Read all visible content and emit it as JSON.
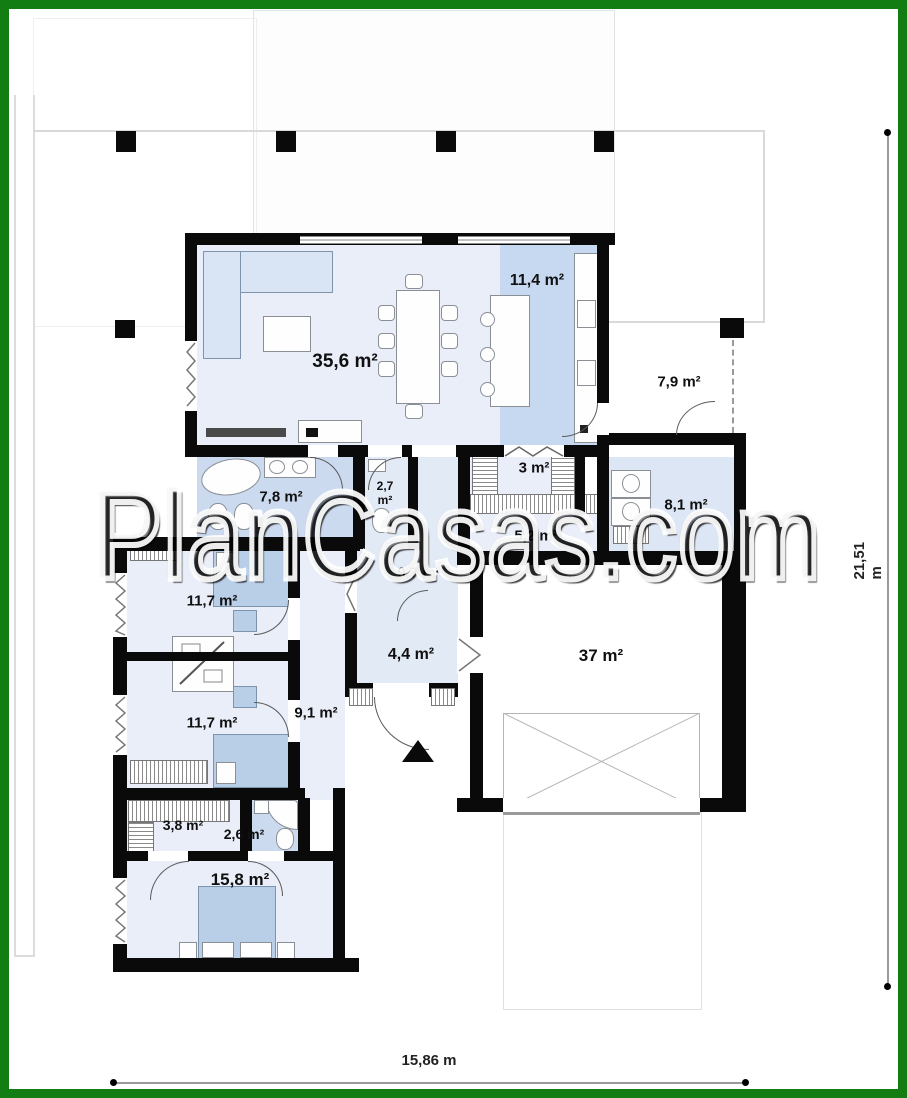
{
  "watermark": "PlanCasas.com",
  "dimensions": {
    "width_label": "15,86 m",
    "height_label": "21,51 m"
  },
  "rooms": {
    "living": "35,6 m²",
    "kitchen": "11,4 m²",
    "porch": "7,9 m²",
    "pantry": "3 m²",
    "wc_line1": "2,7",
    "wc_line2": "m²",
    "bath": "7,8 m²",
    "utility": "8,1 m²",
    "corridor_small": "5,2 m²",
    "hall": "9,7 m²",
    "bedroom1": "11,7 m²",
    "entry": "4,4 m²",
    "garage": "37 m²",
    "corridor": "9,1 m²",
    "bedroom2": "11,7 m²",
    "wardrobe": "3,8 m²",
    "bath2": "2,6 m²",
    "master_bedroom": "15,8 m²"
  },
  "colors": {
    "frame": "#127d12",
    "roomFloor": "#e9eef9",
    "bathFloor": "#ccdaf0",
    "kitchenBand": "#c7d9f0",
    "bedBlue": "#b9cfe8"
  }
}
